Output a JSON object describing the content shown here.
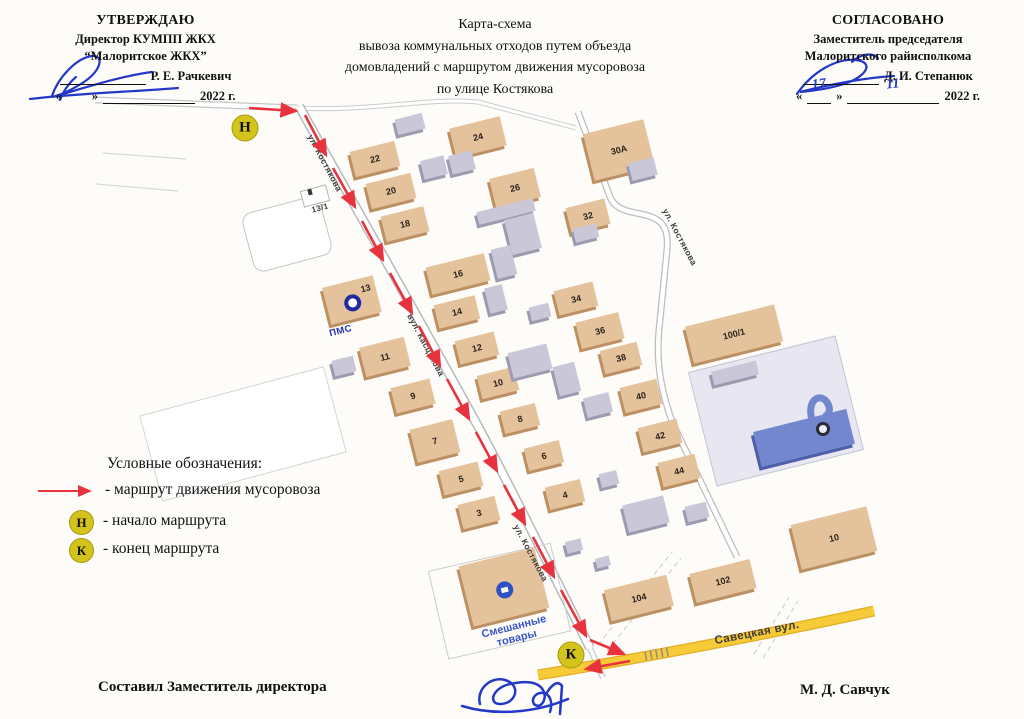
{
  "approval_left": {
    "line1": "УТВЕРЖДАЮ",
    "line2": "Директор КУМПП ЖКХ",
    "line3": "“Малоритское ЖКХ”",
    "name": "Р. Е. Рачкевич",
    "q1": "«",
    "q2": "»",
    "year": "2022 г."
  },
  "title": {
    "line1": "Карта-схема",
    "line2": "вывоза коммунальных отходов путем объезда",
    "line3": "домовладений с маршрутом движения мусоровоза",
    "line4": "по улице Костякова"
  },
  "approval_right": {
    "line1": "СОГЛАСОВАНО",
    "line2": "Заместитель председателя",
    "line3": "Малоритского райисполкома",
    "name": "Д. И. Степанюк",
    "q1": "«",
    "q2": "»",
    "date_day": "17",
    "date_month": "11",
    "year": "2022 г."
  },
  "legend": {
    "title": "Условные обозначения:",
    "route": "- маршрут движения мусоровоза",
    "start": "- начало маршрута",
    "end": "- конец маршрута",
    "start_letter": "Н",
    "end_letter": "К"
  },
  "footer": {
    "left": "Составил Заместитель директора",
    "right": "М. Д. Савчук"
  },
  "map": {
    "pms_label": "ПМС",
    "shop_line1": "Смешанные",
    "shop_line2": "товары",
    "colors": {
      "beige": "#e4c29c",
      "beigeSide": "#bd9064",
      "gray": "#c9c7d8",
      "graySide": "#9d9ab0",
      "blue": "#7287ce",
      "blueSide": "#4d5fa8",
      "lav": "#e7e6f1",
      "roadYellow": "#f7cb37",
      "routeRed": "#e8333e",
      "markerYellow": "#d3c31b"
    },
    "markers": [
      {
        "letter": "Н",
        "x": 245,
        "y": 128
      },
      {
        "letter": "К",
        "x": 571,
        "y": 655
      }
    ],
    "street_labels": [
      {
        "text": "ул. Костякова",
        "x": 325,
        "y": 163,
        "rot": 62,
        "size": 8.5
      },
      {
        "text": "вул. Касцякова",
        "x": 426,
        "y": 345,
        "rot": 62,
        "size": 8.5
      },
      {
        "text": "ул. Костякова",
        "x": 531,
        "y": 553,
        "rot": 62,
        "size": 8.5
      },
      {
        "text": "ул. Костякова",
        "x": 680,
        "y": 237,
        "rot": 62,
        "size": 8.5
      },
      {
        "text": "Савецкая вул.",
        "x": 757,
        "y": 633,
        "rot": -11,
        "size": 11.5
      },
      {
        "text": "13/1",
        "x": 320,
        "y": 208,
        "rot": -15,
        "size": 8
      }
    ],
    "buildings": [
      {
        "t": "22",
        "x": 352,
        "y": 146,
        "w": 46,
        "h": 26,
        "c": "be"
      },
      {
        "t": "20",
        "x": 368,
        "y": 178,
        "w": 46,
        "h": 26,
        "c": "be"
      },
      {
        "t": "18",
        "x": 383,
        "y": 211,
        "w": 44,
        "h": 26,
        "c": "be"
      },
      {
        "t": "24",
        "x": 452,
        "y": 122,
        "w": 52,
        "h": 30,
        "c": "be"
      },
      {
        "t": "26",
        "x": 492,
        "y": 173,
        "w": 46,
        "h": 30,
        "c": "be"
      },
      {
        "t": "32",
        "x": 568,
        "y": 203,
        "w": 40,
        "h": 26,
        "c": "be"
      },
      {
        "t": "30А",
        "x": 588,
        "y": 126,
        "w": 62,
        "h": 48,
        "c": "be"
      },
      {
        "t": "16",
        "x": 428,
        "y": 260,
        "w": 60,
        "h": 28,
        "c": "be"
      },
      {
        "t": "14",
        "x": 436,
        "y": 300,
        "w": 42,
        "h": 24,
        "c": "be"
      },
      {
        "t": "12",
        "x": 457,
        "y": 336,
        "w": 40,
        "h": 24,
        "c": "be"
      },
      {
        "t": "10",
        "x": 479,
        "y": 371,
        "w": 38,
        "h": 24,
        "c": "be"
      },
      {
        "t": "8",
        "x": 502,
        "y": 407,
        "w": 36,
        "h": 23,
        "c": "be"
      },
      {
        "t": "6",
        "x": 526,
        "y": 444,
        "w": 36,
        "h": 23,
        "c": "be"
      },
      {
        "t": "4",
        "x": 547,
        "y": 483,
        "w": 36,
        "h": 23,
        "c": "be"
      },
      {
        "t": "13",
        "x": 326,
        "y": 281,
        "w": 52,
        "h": 38,
        "c": "be",
        "icon": "pms"
      },
      {
        "t": "11",
        "x": 362,
        "y": 342,
        "w": 46,
        "h": 30,
        "c": "be"
      },
      {
        "t": "9",
        "x": 393,
        "y": 383,
        "w": 40,
        "h": 26,
        "c": "be"
      },
      {
        "t": "7",
        "x": 413,
        "y": 424,
        "w": 44,
        "h": 34,
        "c": "be"
      },
      {
        "t": "5",
        "x": 441,
        "y": 466,
        "w": 40,
        "h": 25,
        "c": "be"
      },
      {
        "t": "3",
        "x": 460,
        "y": 500,
        "w": 38,
        "h": 25,
        "c": "be"
      },
      {
        "t": "34",
        "x": 556,
        "y": 286,
        "w": 40,
        "h": 25,
        "c": "be"
      },
      {
        "t": "36",
        "x": 578,
        "y": 317,
        "w": 44,
        "h": 27,
        "c": "be"
      },
      {
        "t": "38",
        "x": 602,
        "y": 346,
        "w": 38,
        "h": 24,
        "c": "be"
      },
      {
        "t": "40",
        "x": 622,
        "y": 383,
        "w": 38,
        "h": 26,
        "c": "be"
      },
      {
        "t": "42",
        "x": 640,
        "y": 423,
        "w": 40,
        "h": 25,
        "c": "be"
      },
      {
        "t": "44",
        "x": 660,
        "y": 458,
        "w": 38,
        "h": 25,
        "c": "be"
      },
      {
        "t": "100/1",
        "x": 688,
        "y": 315,
        "w": 92,
        "h": 38,
        "c": "be"
      },
      {
        "t": "102",
        "x": 692,
        "y": 566,
        "w": 62,
        "h": 30,
        "c": "be"
      },
      {
        "t": "104",
        "x": 607,
        "y": 582,
        "w": 64,
        "h": 32,
        "c": "be"
      },
      {
        "t": "10",
        "x": 795,
        "y": 515,
        "w": 78,
        "h": 46,
        "c": "be"
      },
      {
        "t": "",
        "x": 700,
        "y": 352,
        "w": 152,
        "h": 118,
        "c": "lav"
      },
      {
        "t": "",
        "x": 756,
        "y": 420,
        "w": 96,
        "h": 36,
        "c": "bl"
      },
      {
        "t": "",
        "x": 465,
        "y": 556,
        "w": 78,
        "h": 62,
        "c": "be",
        "icon": "shop"
      },
      {
        "t": "",
        "x": 396,
        "y": 116,
        "w": 28,
        "h": 16,
        "c": "gr"
      },
      {
        "t": "",
        "x": 422,
        "y": 158,
        "w": 24,
        "h": 19,
        "c": "gr"
      },
      {
        "t": "",
        "x": 450,
        "y": 153,
        "w": 24,
        "h": 19,
        "c": "gr"
      },
      {
        "t": "",
        "x": 477,
        "y": 205,
        "w": 58,
        "h": 13,
        "c": "gr"
      },
      {
        "t": "",
        "x": 508,
        "y": 216,
        "w": 30,
        "h": 36,
        "c": "gr"
      },
      {
        "t": "",
        "x": 574,
        "y": 226,
        "w": 24,
        "h": 14,
        "c": "gr"
      },
      {
        "t": "",
        "x": 494,
        "y": 247,
        "w": 20,
        "h": 30,
        "c": "gr"
      },
      {
        "t": "",
        "x": 487,
        "y": 286,
        "w": 18,
        "h": 26,
        "c": "gr"
      },
      {
        "t": "",
        "x": 630,
        "y": 160,
        "w": 26,
        "h": 18,
        "c": "gr"
      },
      {
        "t": "",
        "x": 530,
        "y": 305,
        "w": 20,
        "h": 14,
        "c": "gr"
      },
      {
        "t": "",
        "x": 510,
        "y": 348,
        "w": 40,
        "h": 26,
        "c": "gr"
      },
      {
        "t": "",
        "x": 556,
        "y": 364,
        "w": 22,
        "h": 30,
        "c": "gr"
      },
      {
        "t": "",
        "x": 585,
        "y": 395,
        "w": 26,
        "h": 20,
        "c": "gr"
      },
      {
        "t": "",
        "x": 600,
        "y": 472,
        "w": 18,
        "h": 14,
        "c": "gr"
      },
      {
        "t": "",
        "x": 625,
        "y": 500,
        "w": 42,
        "h": 28,
        "c": "gr"
      },
      {
        "t": "",
        "x": 686,
        "y": 504,
        "w": 22,
        "h": 16,
        "c": "gr"
      },
      {
        "t": "",
        "x": 333,
        "y": 358,
        "w": 22,
        "h": 16,
        "c": "gr"
      },
      {
        "t": "",
        "x": 712,
        "y": 366,
        "w": 46,
        "h": 14,
        "c": "gr"
      },
      {
        "t": "",
        "x": 566,
        "y": 540,
        "w": 16,
        "h": 12,
        "c": "gr"
      },
      {
        "t": "",
        "x": 596,
        "y": 557,
        "w": 14,
        "h": 10,
        "c": "gr"
      }
    ]
  }
}
